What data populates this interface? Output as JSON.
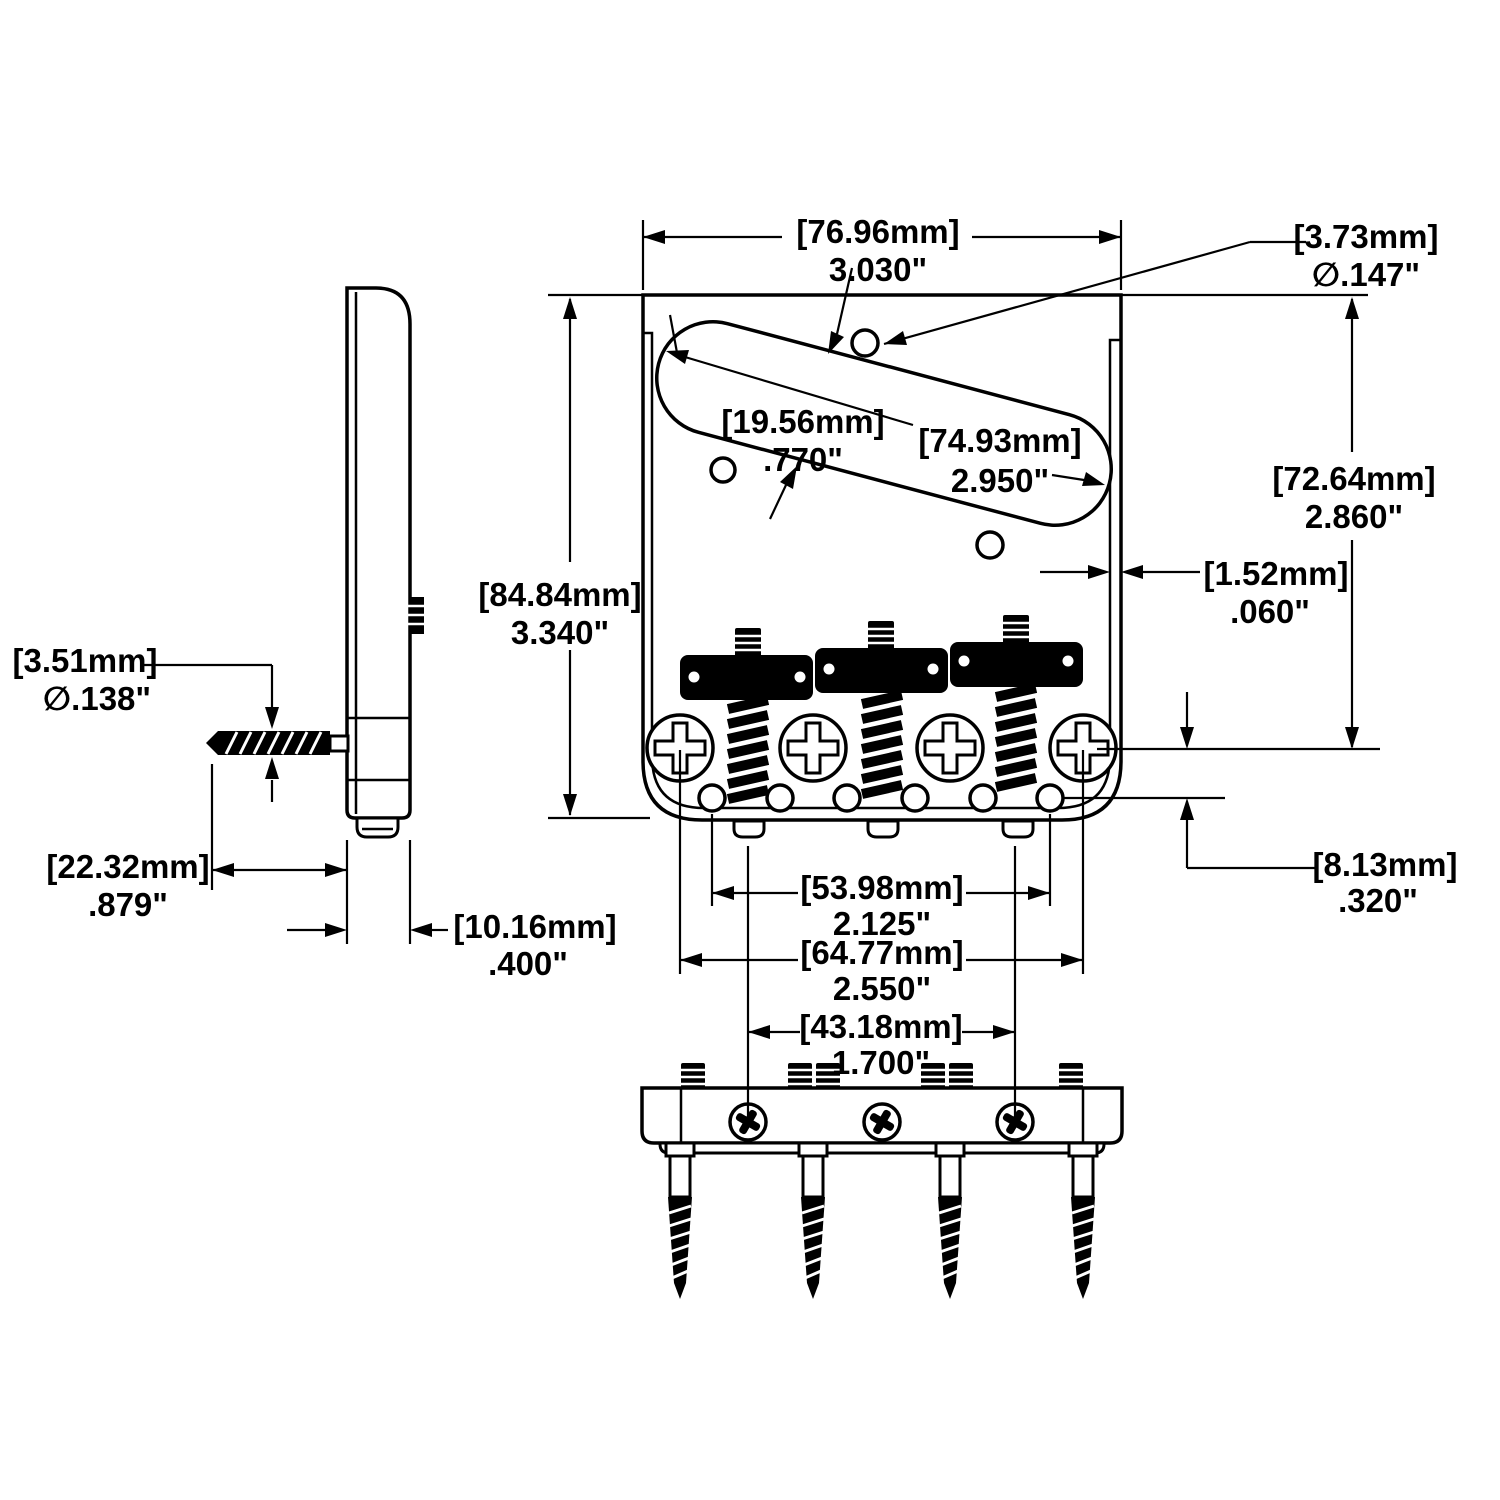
{
  "drawing": {
    "kind": "guitar-bridge-dimension-drawing",
    "units": [
      "mm",
      "inch"
    ]
  },
  "dimensions": {
    "plate_width": {
      "mm": "[76.96mm]",
      "in": "3.030\""
    },
    "mount_hole_diameter": {
      "mm": "[3.73mm]",
      "in": "∅.147\""
    },
    "plate_length": {
      "mm": "[84.84mm]",
      "in": "3.340\""
    },
    "pickup_cutout_width": {
      "mm": "[19.56mm]",
      "in": ".770\""
    },
    "pickup_cutout_length": {
      "mm": "[74.93mm]",
      "in": "2.950\""
    },
    "top_edge_to_screws": {
      "mm": "[72.64mm]",
      "in": "2.860\""
    },
    "wall_thickness": {
      "mm": "[1.52mm]",
      "in": ".060\""
    },
    "wood_screw_diameter": {
      "mm": "[3.51mm]",
      "in": "∅.138\""
    },
    "wood_screw_length": {
      "mm": "[22.32mm]",
      "in": ".879\""
    },
    "side_profile_depth": {
      "mm": "[10.16mm]",
      "in": ".400\""
    },
    "string_hole_spacing": {
      "mm": "[53.98mm]",
      "in": "2.125\""
    },
    "mount_screw_spacing": {
      "mm": "[64.77mm]",
      "in": "2.550\""
    },
    "screws_to_string_holes": {
      "mm": "[8.13mm]",
      "in": ".320\""
    },
    "intonation_screw_spacing": {
      "mm": "[43.18mm]",
      "in": "1.700\""
    }
  }
}
